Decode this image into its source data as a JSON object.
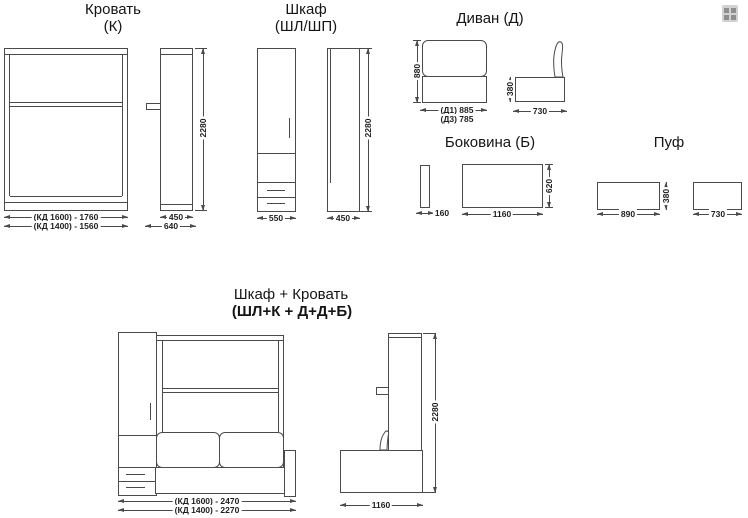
{
  "page": {
    "background": "#ffffff",
    "line_color": "#4a4a4a",
    "text_color": "#151515"
  },
  "corner_icon": {
    "name": "grid-icon"
  },
  "bed": {
    "title": "Кровать",
    "subtitle": "(К)",
    "dim_width_kd1600": "(КД 1600) - 1760",
    "dim_width_kd1400": "(КД 1400) - 1560",
    "dim_height": "2280",
    "dim_depth": "450",
    "dim_depth_total": "640"
  },
  "wardrobe": {
    "title": "Шкаф",
    "subtitle": "(ШЛ/ШП)",
    "dim_width": "550",
    "dim_depth": "450",
    "dim_height": "2280"
  },
  "sofa": {
    "title": "Диван (Д)",
    "dim_height": "880",
    "dim_width_d1": "(Д1) 885",
    "dim_width_d3": "(Д3) 785",
    "dim_seat_height": "380",
    "dim_depth": "730"
  },
  "side_panel": {
    "title": "Боковина (Б)",
    "dim_thickness": "160",
    "dim_length": "1160",
    "dim_height": "620"
  },
  "pouf": {
    "title": "Пуф",
    "dim_width": "890",
    "dim_height": "380",
    "dim_depth": "730"
  },
  "combo": {
    "title": "Шкаф + Кровать",
    "subtitle": "(ШЛ+К + Д+Д+Б)",
    "dim_width_kd1600": "(КД 1600) - 2470",
    "dim_width_kd1400": "(КД 1400) - 2270",
    "dim_height": "2280",
    "dim_depth": "1160"
  }
}
